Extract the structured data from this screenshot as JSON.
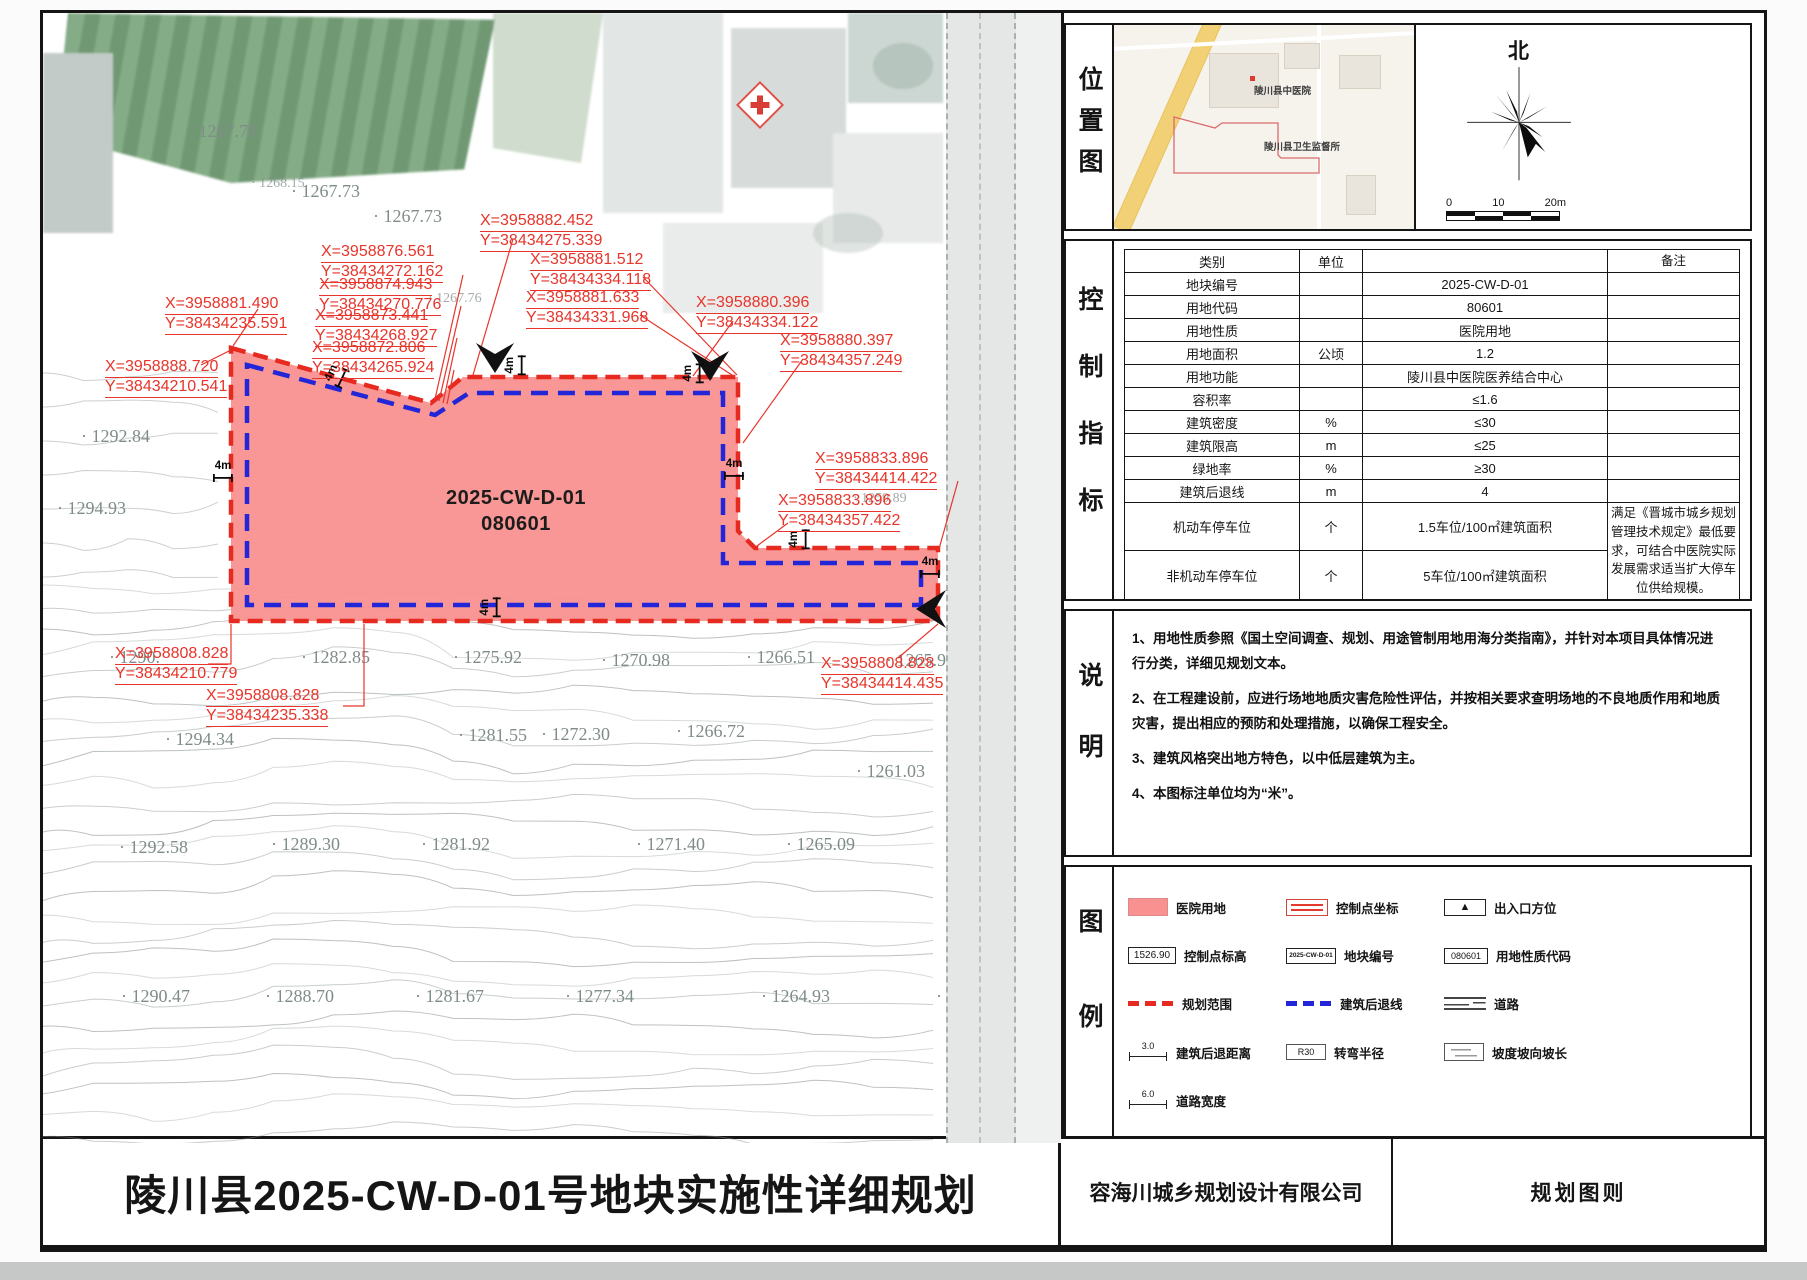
{
  "sheet": {
    "title": "陵川县2025-CW-D-01号地块实施性详细规划",
    "company": "容海川城乡规划设计有限公司",
    "sheet_type": "规划图则"
  },
  "colors": {
    "parcel_fill": "#f89190",
    "boundary_red": "#e62a20",
    "setback_blue": "#2326d8"
  },
  "map": {
    "parcel": {
      "code": "2025-CW-D-01",
      "land_use_code": "080601"
    },
    "coordinates": [
      {
        "x": "X=3958888.720",
        "y": "Y=38434210.541",
        "left": 62,
        "top": 345
      },
      {
        "x": "X=3958881.490",
        "y": "Y=38434235.591",
        "left": 122,
        "top": 282
      },
      {
        "x": "X=3958876.561",
        "y": "Y=38434272.162",
        "left": 278,
        "top": 230
      },
      {
        "x": "X=3958874.943",
        "y": "Y=38434270.776",
        "left": 276,
        "top": 263
      },
      {
        "x": "X=3958873.441",
        "y": "Y=38434268.927",
        "left": 272,
        "top": 294
      },
      {
        "x": "X=3958872.806",
        "y": "Y=38434265.924",
        "left": 269,
        "top": 326
      },
      {
        "x": "X=3958882.452",
        "y": "Y=38434275.339",
        "left": 437,
        "top": 199
      },
      {
        "x": "X=3958881.512",
        "y": "Y=38434334.118",
        "left": 487,
        "top": 238
      },
      {
        "x": "X=3958881.633",
        "y": "Y=38434331.968",
        "left": 483,
        "top": 276
      },
      {
        "x": "X=3958880.396",
        "y": "Y=38434334.122",
        "left": 653,
        "top": 281
      },
      {
        "x": "X=3958880.397",
        "y": "Y=38434357.249",
        "left": 737,
        "top": 319
      },
      {
        "x": "X=3958833.896",
        "y": "Y=38434414.422",
        "left": 772,
        "top": 437
      },
      {
        "x": "X=3958833.896",
        "y": "Y=38434357.422",
        "left": 735,
        "top": 479
      },
      {
        "x": "X=3958808.828",
        "y": "Y=38434210.779",
        "left": 72,
        "top": 632
      },
      {
        "x": "X=3958808.828",
        "y": "Y=38434235.338",
        "left": 163,
        "top": 674
      },
      {
        "x": "X=3958808.828",
        "y": "Y=38434414.435",
        "left": 778,
        "top": 642
      }
    ],
    "elevations": [
      {
        "v": "1267.70",
        "left": 145,
        "top": 108
      },
      {
        "v": "1268.15",
        "left": 208,
        "top": 163,
        "cls": "sm"
      },
      {
        "v": "1267.73",
        "left": 248,
        "top": 168
      },
      {
        "v": "1267.73",
        "left": 330,
        "top": 193
      },
      {
        "v": "1267.76",
        "left": 385,
        "top": 278,
        "cls": "sm"
      },
      {
        "v": "1292.84",
        "left": 38,
        "top": 413
      },
      {
        "v": "1294.93",
        "left": 14,
        "top": 485
      },
      {
        "v": "1259.89",
        "left": 810,
        "top": 478,
        "cls": "sm"
      },
      {
        "v": "1259.35",
        "left": 940,
        "top": 466
      },
      {
        "v": "1290.",
        "left": 66,
        "top": 634
      },
      {
        "v": "1282.85",
        "left": 258,
        "top": 634
      },
      {
        "v": "1275.92",
        "left": 410,
        "top": 634
      },
      {
        "v": "1270.98",
        "left": 558,
        "top": 637
      },
      {
        "v": "1266.51",
        "left": 703,
        "top": 634
      },
      {
        "v": "1265.91",
        "left": 843,
        "top": 637
      },
      {
        "v": "1294.34",
        "left": 122,
        "top": 716
      },
      {
        "v": "1281.55",
        "left": 415,
        "top": 712
      },
      {
        "v": "1272.30",
        "left": 498,
        "top": 711
      },
      {
        "v": "1266.72",
        "left": 633,
        "top": 708
      },
      {
        "v": "1261.03",
        "left": 813,
        "top": 748
      },
      {
        "v": "1292.58",
        "left": 76,
        "top": 824
      },
      {
        "v": "1289.30",
        "left": 228,
        "top": 821
      },
      {
        "v": "1281.92",
        "left": 378,
        "top": 821
      },
      {
        "v": "1271.40",
        "left": 593,
        "top": 821
      },
      {
        "v": "1265.09",
        "left": 743,
        "top": 821
      },
      {
        "v": "1290.47",
        "left": 78,
        "top": 973
      },
      {
        "v": "1288.70",
        "left": 222,
        "top": 973
      },
      {
        "v": "1281.67",
        "left": 372,
        "top": 973
      },
      {
        "v": "1277.34",
        "left": 522,
        "top": 973
      },
      {
        "v": "1264.93",
        "left": 718,
        "top": 973
      },
      {
        "v": "1259.76",
        "left": 893,
        "top": 973
      },
      {
        "v": "12",
        "left": 1000,
        "top": 252
      },
      {
        "v": "125",
        "left": 996,
        "top": 396
      },
      {
        "v": "12",
        "left": 1002,
        "top": 602
      },
      {
        "v": "125",
        "left": 993,
        "top": 776
      }
    ],
    "setback_dims": [
      {
        "t": "4m",
        "left": 283,
        "top": 352,
        "rot": -65
      },
      {
        "t": "4m",
        "left": 462,
        "top": 342,
        "rot": -90
      },
      {
        "t": "4m",
        "left": 640,
        "top": 350,
        "rot": -90
      },
      {
        "t": "4m",
        "left": 681,
        "top": 446
      },
      {
        "t": "4m",
        "left": 746,
        "top": 516,
        "rot": -90
      },
      {
        "t": "4m",
        "left": 877,
        "top": 544
      },
      {
        "t": "4m",
        "left": 437,
        "top": 584,
        "rot": -90
      },
      {
        "t": "4m",
        "left": 170,
        "top": 448
      }
    ]
  },
  "panel": {
    "location": {
      "label": "位置图",
      "hospital_label": "陵川县中医院",
      "health_office_label": "陵川县卫生监督所",
      "north": "北",
      "scale_ticks": [
        "0",
        "10",
        "20m"
      ]
    },
    "indicators": {
      "label": "控制指标",
      "rows": [
        {
          "name": "类别",
          "unit": "单位",
          "value": "",
          "remark": "备注"
        },
        {
          "name": "地块编号",
          "unit": "",
          "value": "2025-CW-D-01",
          "remark": ""
        },
        {
          "name": "用地代码",
          "unit": "",
          "value": "80601",
          "remark": ""
        },
        {
          "name": "用地性质",
          "unit": "",
          "value": "医院用地",
          "remark": ""
        },
        {
          "name": "用地面积",
          "unit": "公顷",
          "value": "1.2",
          "remark": ""
        },
        {
          "name": "用地功能",
          "unit": "",
          "value": "陵川县中医院医养结合中心",
          "remark": ""
        },
        {
          "name": "容积率",
          "unit": "",
          "value": "≤1.6",
          "remark": ""
        },
        {
          "name": "建筑密度",
          "unit": "%",
          "value": "≤30",
          "remark": ""
        },
        {
          "name": "建筑限高",
          "unit": "m",
          "value": "≤25",
          "remark": ""
        },
        {
          "name": "绿地率",
          "unit": "%",
          "value": "≥30",
          "remark": ""
        },
        {
          "name": "建筑后退线",
          "unit": "m",
          "value": "4",
          "remark": ""
        },
        {
          "name": "机动车停车位",
          "unit": "个",
          "value": "1.5车位/100㎡建筑面积",
          "remark": "满足《晋城市城乡规划管理技术规定》最低要求，可结合中医院实际发展需求适当扩大停车位供给规模。",
          "remark_rows": 2,
          "cls": "tall"
        },
        {
          "name": "非机动车停车位",
          "unit": "个",
          "value": "5车位/100㎡建筑面积",
          "no_remark": true,
          "cls": "tall"
        }
      ]
    },
    "notes": {
      "label": "说明",
      "items": [
        {
          "t": "1、用地性质参照《国土空间调查、规划、用途管制用地用海分类指南》，并针对本项目具体情况进行分类，详细见规划文本。"
        },
        {
          "t": "2、在工程建设前，应进行场地地质灾害危险性评估，并按相关要求查明场地的不良地质作用和地质灾害，提出相应的预防和处理措施，以确保工程安全。"
        },
        {
          "t": "3、建筑风格突出地方特色，以中低层建筑为主。"
        },
        {
          "t": "4、本图标注单位均为“米”。"
        }
      ]
    },
    "legend": {
      "label": "图例",
      "items": [
        {
          "icon": "hospital-swatch",
          "label": "医院用地"
        },
        {
          "icon": "coord-box",
          "label": "控制点坐标"
        },
        {
          "icon": "entrance-box",
          "label": "出入口方位",
          "icon_text": "▲"
        },
        {
          "icon": "elev-box",
          "label": "控制点标高",
          "icon_text": "1526.90"
        },
        {
          "icon": "plot-box",
          "label": "地块编号",
          "icon_text": "2025-CW-D-01"
        },
        {
          "icon": "code-box",
          "label": "用地性质代码",
          "icon_text": "080601"
        },
        {
          "icon": "red-dash",
          "label": "规划范围"
        },
        {
          "icon": "blue-dash",
          "label": "建筑后退线"
        },
        {
          "icon": "road",
          "label": "道路"
        },
        {
          "icon": "dim-box",
          "label": "建筑后退距离",
          "icon_text": "3.0"
        },
        {
          "icon": "radius-box",
          "label": "转弯半径",
          "icon_text": "R30"
        },
        {
          "icon": "slope-box",
          "label": "坡度坡向坡长"
        },
        {
          "icon": "dim-box",
          "label": "道路宽度",
          "icon_text": "6.0"
        }
      ]
    }
  }
}
